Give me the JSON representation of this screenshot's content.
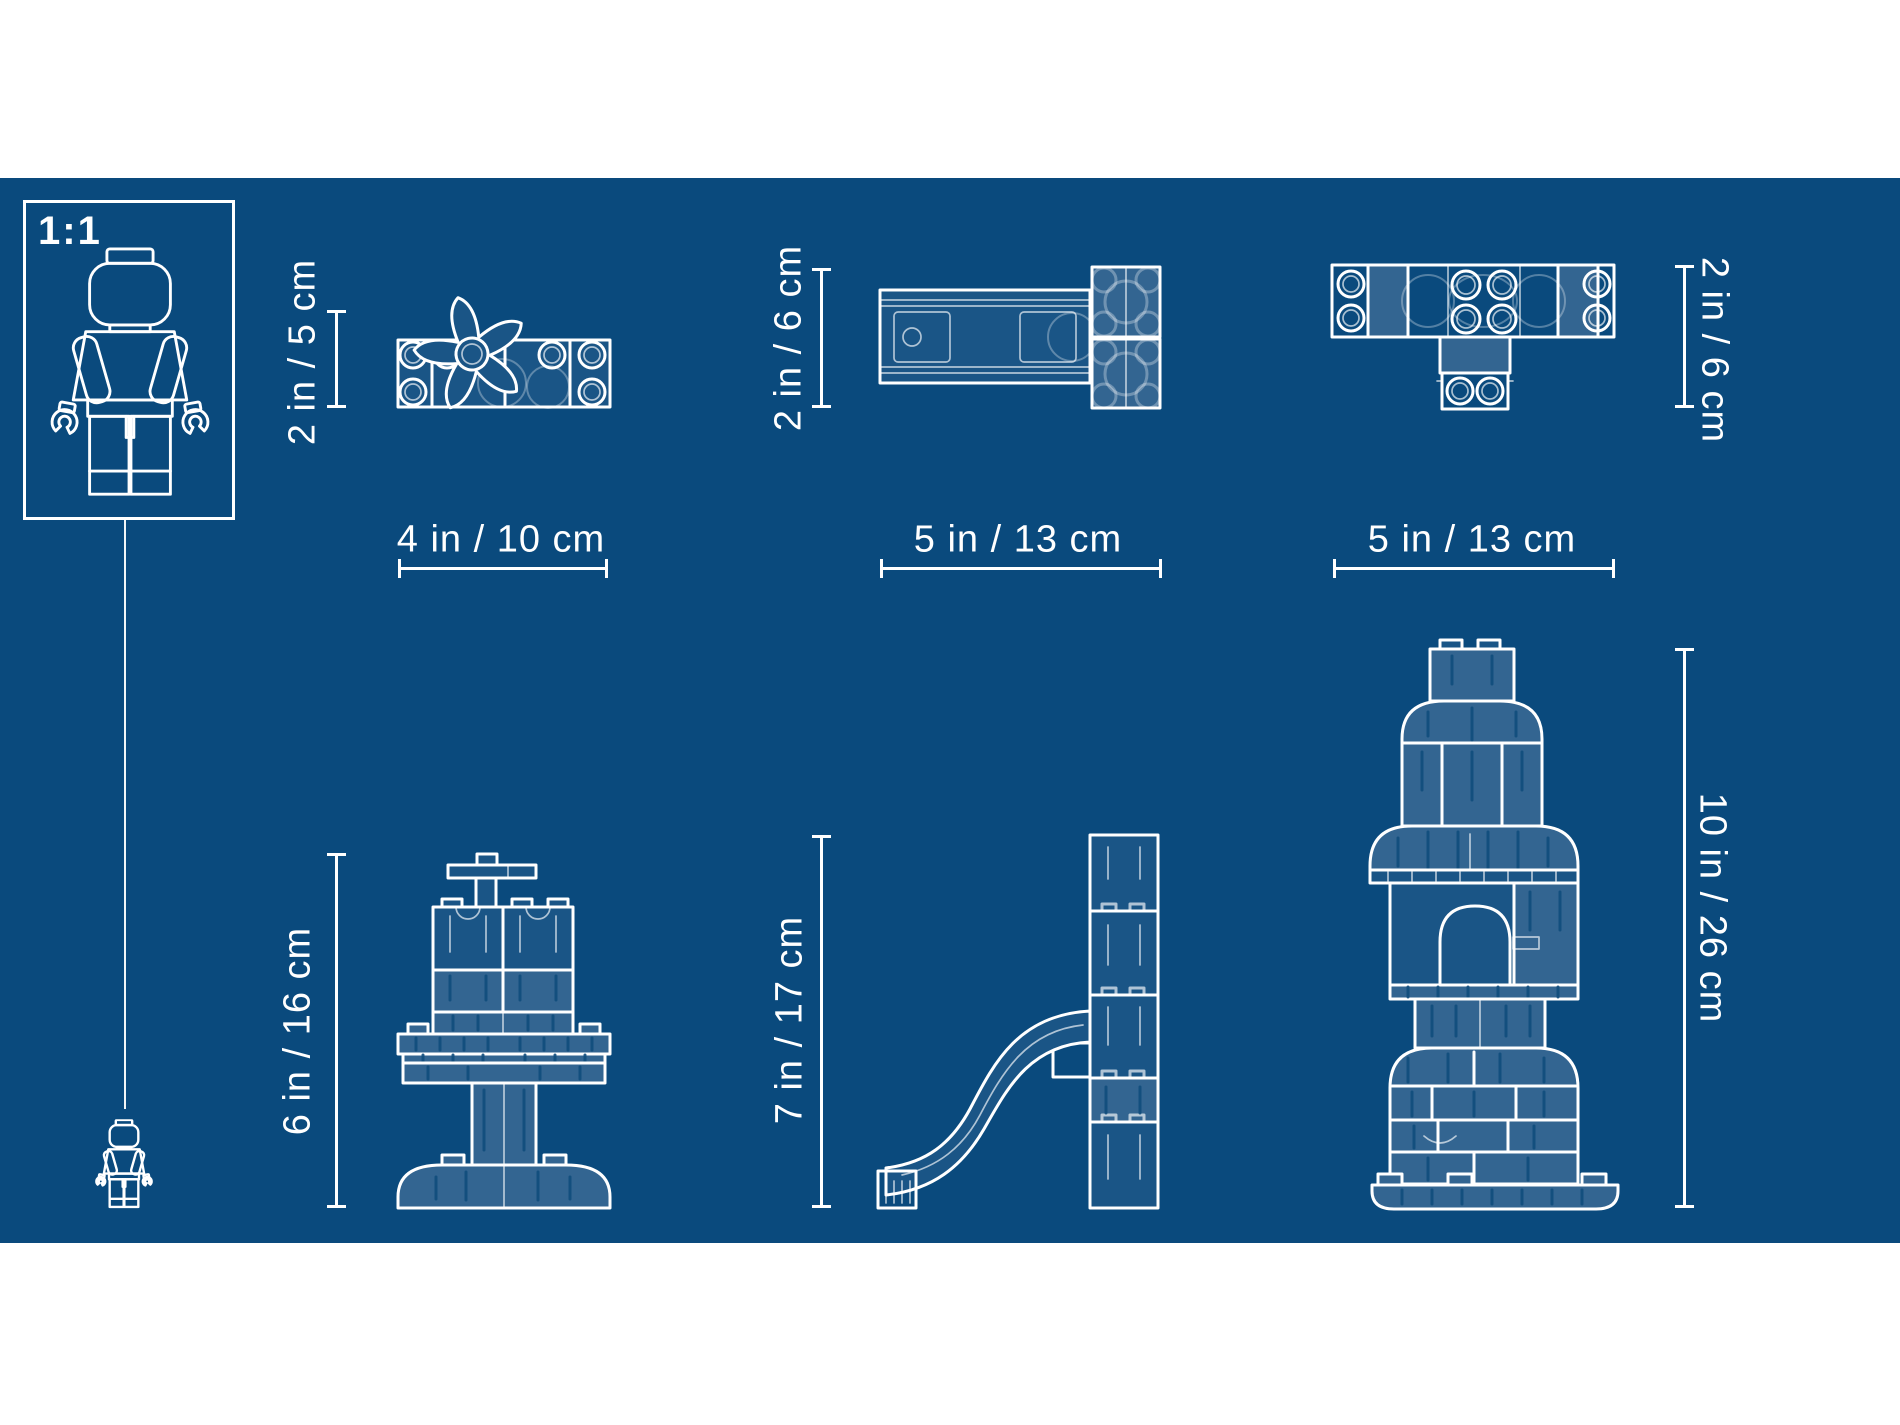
{
  "colors": {
    "page_background": "#ffffff",
    "canvas_background": "#0a4a7d",
    "line": "#ffffff",
    "brick_fill_light": "#336591",
    "brick_fill_dark": "#1a5586"
  },
  "scale_reference": {
    "ratio_label": "1:1",
    "icon": "minifigure-outline"
  },
  "models": [
    {
      "name": "flower-plate",
      "height_label": "2 in / 5 cm",
      "width_label": "4 in / 10 cm"
    },
    {
      "name": "rectangular-brick",
      "height_label": "2 in / 6 cm",
      "width_label": "5 in / 13 cm"
    },
    {
      "name": "t-shaped-assembly",
      "height_label": "2 in / 6 cm",
      "width_label": "5 in / 13 cm"
    },
    {
      "name": "pedestal-table",
      "height_label": "6 in / 16 cm"
    },
    {
      "name": "slide",
      "height_label": "7 in / 17 cm"
    },
    {
      "name": "rocket-tower",
      "height_label": "10 in / 26 cm"
    }
  ]
}
